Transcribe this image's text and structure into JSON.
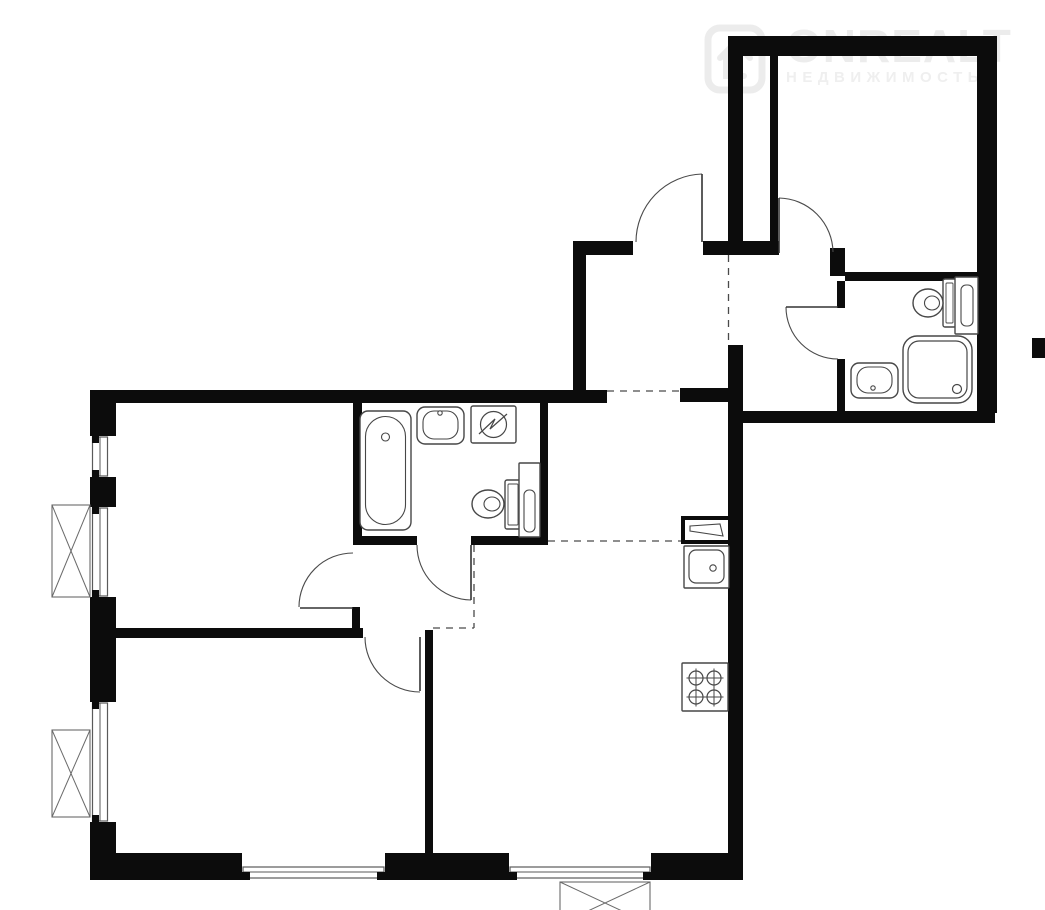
{
  "watermark": {
    "brand": "ONREALT",
    "subtitle": "НЕДВИЖИМОСТЬ",
    "icon": "onrealt-house-logo-icon",
    "color": "#ececec"
  },
  "plan": {
    "canvas": {
      "w": 1045,
      "h": 910
    },
    "colors": {
      "wall": "#0c0c0c",
      "fixture": "#474747",
      "door": "#4a4a4a",
      "dashed": "#4a4a4a",
      "window": "#5a5a5a",
      "background": "#ffffff"
    },
    "walls": [
      {
        "x": 728,
        "y": 36,
        "w": 269,
        "h": 20
      },
      {
        "x": 977,
        "y": 36,
        "w": 20,
        "h": 377
      },
      {
        "x": 743,
        "y": 411,
        "w": 252,
        "h": 12
      },
      {
        "x": 728,
        "y": 36,
        "w": 15,
        "h": 219
      },
      {
        "x": 703,
        "y": 241,
        "w": 76,
        "h": 14
      },
      {
        "x": 573,
        "y": 241,
        "w": 60,
        "h": 14
      },
      {
        "x": 573,
        "y": 241,
        "w": 13,
        "h": 152
      },
      {
        "x": 770,
        "y": 52,
        "w": 8,
        "h": 190
      },
      {
        "x": 830,
        "y": 248,
        "w": 15,
        "h": 28
      },
      {
        "x": 845,
        "y": 272,
        "w": 132,
        "h": 9
      },
      {
        "x": 837,
        "y": 281,
        "w": 8,
        "h": 27
      },
      {
        "x": 837,
        "y": 359,
        "w": 8,
        "h": 53
      },
      {
        "x": 1032,
        "y": 338,
        "w": 13,
        "h": 20
      },
      {
        "x": 90,
        "y": 390,
        "w": 517,
        "h": 13
      },
      {
        "x": 680,
        "y": 388,
        "w": 48,
        "h": 14
      },
      {
        "x": 728,
        "y": 345,
        "w": 15,
        "h": 535
      },
      {
        "x": 90,
        "y": 390,
        "w": 26,
        "h": 46
      },
      {
        "x": 90,
        "y": 477,
        "w": 26,
        "h": 30
      },
      {
        "x": 90,
        "y": 597,
        "w": 26,
        "h": 105
      },
      {
        "x": 90,
        "y": 822,
        "w": 26,
        "h": 58
      },
      {
        "x": 90,
        "y": 853,
        "w": 152,
        "h": 27
      },
      {
        "x": 385,
        "y": 853,
        "w": 124,
        "h": 27
      },
      {
        "x": 651,
        "y": 853,
        "w": 92,
        "h": 27
      },
      {
        "x": 90,
        "y": 628,
        "w": 273,
        "h": 10
      },
      {
        "x": 352,
        "y": 607,
        "w": 8,
        "h": 26
      },
      {
        "x": 353,
        "y": 403,
        "w": 9,
        "h": 140
      },
      {
        "x": 353,
        "y": 536,
        "w": 64,
        "h": 9
      },
      {
        "x": 471,
        "y": 536,
        "w": 77,
        "h": 9
      },
      {
        "x": 540,
        "y": 400,
        "w": 8,
        "h": 145
      },
      {
        "x": 425,
        "y": 630,
        "w": 8,
        "h": 223
      }
    ],
    "windows": [
      {
        "x": 90,
        "y": 436,
        "w": 26,
        "h": 41,
        "orient": "v"
      },
      {
        "x": 90,
        "y": 507,
        "w": 26,
        "h": 90,
        "orient": "v"
      },
      {
        "x": 90,
        "y": 702,
        "w": 26,
        "h": 120,
        "orient": "v"
      },
      {
        "x": 242,
        "y": 853,
        "w": 143,
        "h": 27,
        "orient": "h"
      },
      {
        "x": 509,
        "y": 853,
        "w": 142,
        "h": 27,
        "orient": "h"
      }
    ],
    "ac_units": [
      {
        "x": 52,
        "y": 505,
        "w": 38,
        "h": 92
      },
      {
        "x": 52,
        "y": 730,
        "w": 38,
        "h": 87
      },
      {
        "x": 560,
        "y": 882,
        "w": 90,
        "h": 42
      }
    ],
    "dashed_lines": [
      {
        "x1": 728.5,
        "y1": 255,
        "x2": 728.5,
        "y2": 345
      },
      {
        "x1": 607,
        "y1": 391,
        "x2": 680,
        "y2": 391
      },
      {
        "x1": 548,
        "y1": 541,
        "x2": 683,
        "y2": 541
      },
      {
        "x1": 474,
        "y1": 545,
        "x2": 474,
        "y2": 628
      },
      {
        "x1": 433,
        "y1": 628,
        "x2": 474,
        "y2": 628
      }
    ],
    "doors": [
      {
        "name": "entrance-door",
        "panel": [
          702,
          242,
          702,
          174
        ],
        "arc": {
          "sx": 702,
          "sy": 174,
          "r": 68,
          "ex": 636,
          "ey": 242,
          "sweep": 0
        }
      },
      {
        "name": "bedroom-door",
        "panel": [
          779,
          253,
          779,
          198
        ],
        "arc": {
          "sx": 779,
          "sy": 198,
          "r": 55,
          "ex": 833,
          "ey": 252,
          "sweep": 1
        }
      },
      {
        "name": "bathroom2-door",
        "panel": [
          838,
          307,
          786,
          307
        ],
        "arc": {
          "sx": 786,
          "sy": 307,
          "r": 52,
          "ex": 838,
          "ey": 359,
          "sweep": 0
        }
      },
      {
        "name": "bathroom1-door",
        "panel": [
          471,
          545,
          471,
          600
        ],
        "arc": {
          "sx": 417,
          "sy": 545,
          "r": 55,
          "ex": 471,
          "ey": 600,
          "sweep": 0
        }
      },
      {
        "name": "living-room-door",
        "panel": [
          353,
          608,
          300,
          608
        ],
        "arc": {
          "sx": 353,
          "sy": 553,
          "r": 54,
          "ex": 299,
          "ey": 607,
          "sweep": 0
        }
      },
      {
        "name": "bedroom2-door",
        "panel": [
          420,
          637,
          420,
          691
        ],
        "arc": {
          "sx": 365,
          "sy": 637,
          "r": 55,
          "ex": 420,
          "ey": 692,
          "sweep": 0
        }
      }
    ],
    "fixtures": [
      {
        "type": "bathtub",
        "name": "bathtub",
        "x": 360,
        "y": 411,
        "w": 51,
        "h": 119
      },
      {
        "type": "sink",
        "name": "bathroom1-sink",
        "x": 417,
        "y": 407,
        "w": 47,
        "h": 37,
        "dot": [
          440,
          413
        ]
      },
      {
        "type": "washer",
        "name": "washing-machine",
        "x": 471,
        "y": 406,
        "w": 45,
        "h": 37
      },
      {
        "type": "toilet",
        "name": "bathroom1-toilet",
        "bowl": [
          488,
          504,
          16,
          14
        ],
        "inner": [
          492,
          504,
          8,
          7
        ],
        "cistern": [
          505,
          480,
          16,
          49
        ]
      },
      {
        "type": "cabinet",
        "name": "bathroom1-cabinet",
        "o": [
          519,
          463,
          21,
          74
        ],
        "i": [
          524,
          490,
          11,
          42
        ]
      },
      {
        "type": "vent",
        "name": "kitchen-vent-box",
        "x": 683,
        "y": 518,
        "w": 47,
        "h": 24
      },
      {
        "type": "ksink",
        "name": "kitchen-sink",
        "x": 684,
        "y": 546,
        "w": 45,
        "h": 42,
        "drain": [
          713,
          568
        ]
      },
      {
        "type": "stove",
        "name": "stove-4-burners",
        "x": 682,
        "y": 663,
        "w": 46,
        "h": 48
      },
      {
        "type": "toilet",
        "name": "bathroom2-toilet",
        "bowl": [
          928,
          303,
          15,
          14
        ],
        "inner": [
          932,
          303,
          7.5,
          7
        ],
        "cistern": [
          943,
          279,
          13,
          48
        ]
      },
      {
        "type": "cabinet",
        "name": "bathroom2-towel-rail",
        "o": [
          955,
          277,
          23,
          57
        ],
        "i": [
          961,
          285,
          12,
          41
        ]
      },
      {
        "type": "shower",
        "name": "shower-tray",
        "x": 903,
        "y": 336,
        "w": 69,
        "h": 67,
        "drain": [
          957,
          389
        ]
      },
      {
        "type": "sink",
        "name": "bathroom2-sink",
        "x": 851,
        "y": 363,
        "w": 47,
        "h": 35,
        "dot": [
          873,
          388
        ]
      }
    ]
  }
}
